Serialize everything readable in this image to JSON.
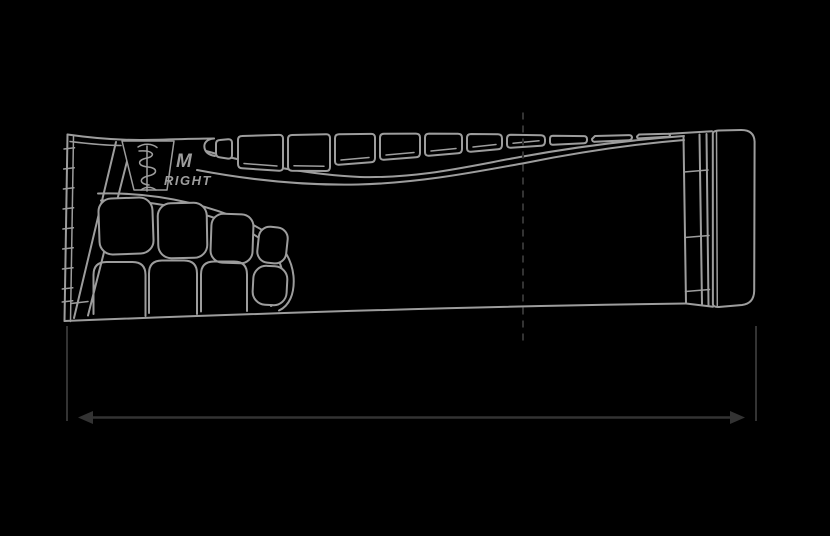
{
  "drawing": {
    "size_label": "M",
    "side_label": "RIGHT",
    "subject": "bicycle-grip-side-profile-technical-drawing",
    "logo_icon": "snake-staff-logo-icon"
  },
  "dimension": {
    "type": "overall-length-double-arrow",
    "label": ""
  },
  "colors": {
    "background": "#000000",
    "outline": "#9d9d9d",
    "centerline_and_dimension": "#333333"
  }
}
